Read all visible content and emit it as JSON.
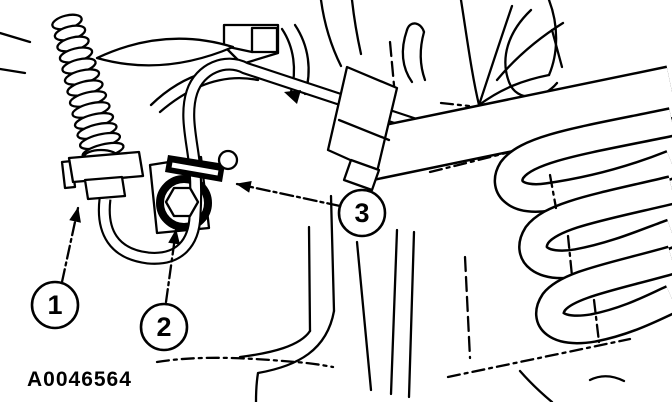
{
  "figure": {
    "code": "A0046564",
    "description": "Line-art service diagram of hose and harness routing with three numbered callouts"
  },
  "callouts": [
    {
      "label": "1"
    },
    {
      "label": "2"
    },
    {
      "label": "3"
    }
  ],
  "colors": {
    "ink": "#000000",
    "paper": "#ffffff"
  }
}
